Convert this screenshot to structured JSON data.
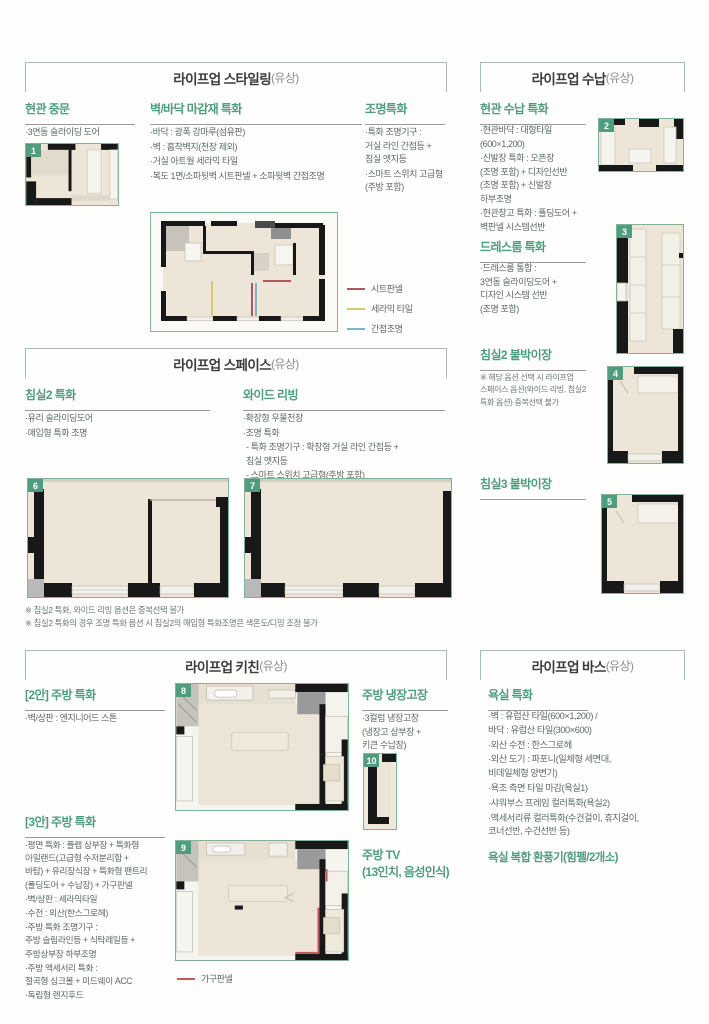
{
  "colors": {
    "accent_green": "#4f9d7e",
    "box_border": "#a3bfb1",
    "body_text": "#5c6b63",
    "wall_black": "#181818",
    "floor_beige": "#ece5d8"
  },
  "styling": {
    "title": "라이프업 스타일링",
    "paid": "(유상)",
    "badge": "1",
    "door": {
      "heading": "현관 중문",
      "items": [
        "·3연동 슬라이딩 도어"
      ]
    },
    "finish": {
      "heading": "벽/바닥 마감재 특화",
      "items": [
        "·바닥 : 광폭 강마루(섬유판)",
        "·벽 : 흡착벽지(천장 제외)",
        "·거실 아트월 세라믹 타일",
        "·복도 1면/소파뒷벽 시트판넬 + 소파뒷벽 간접조명"
      ]
    },
    "lighting": {
      "heading": "조명특화",
      "items": [
        "·특화 조명기구 :\n거실 라인 간접등 +\n침실 엣지등",
        "·스마트 스위치 고급형\n(주방 포함)"
      ]
    },
    "legend": [
      {
        "label": "시트판넬",
        "color": "#b2575b"
      },
      {
        "label": "세라믹 타일",
        "color": "#d9c96d"
      },
      {
        "label": "간접조명",
        "color": "#7db5c9"
      }
    ]
  },
  "sunap": {
    "title": "라이프업 수납",
    "paid": "(유상)",
    "badge2": "2",
    "badge3": "3",
    "badge4": "4",
    "badge5": "5",
    "entry": {
      "heading": "현관 수납 특화",
      "items": [
        "·현관바닥 : 대형타일\n(600×1,200)",
        "·신발장 특화 : 오픈장\n(조명 포함) + 디자인선반\n(조명 포함) + 신발장\n하부조명",
        "·현관창고 특화 : 폴딩도어 +\n벽판넬 시스템선반"
      ]
    },
    "dress": {
      "heading": "드레스룸 특화",
      "items": [
        "·드레스룸 통합 :\n3연동 슬라이딩도어 +\n디자인 시스템 선반\n(조명 포함)"
      ]
    },
    "bed2": {
      "heading": "침실2 붙박이장",
      "note": "※ 해당 옵션 선택 시 라이프업\n스페이스 옵션(와이드 리빙, 침실2\n특화 옵션) 중복선택 불가"
    },
    "bed3": {
      "heading": "침실3 붙박이장"
    }
  },
  "space": {
    "title": "라이프업 스페이스",
    "paid": "(유상)",
    "badge6": "6",
    "badge7": "7",
    "bed2": {
      "heading": "침실2 특화",
      "items": [
        "·유리 슬라이딩도어",
        "·매입형 특화 조명"
      ]
    },
    "wide": {
      "heading": "와이드 리빙",
      "items": [
        "·확장형 우물천장",
        "·조명 특화",
        "- 특화 조명기구 : 확장형 거실 라인 간접등 +\n침실 엣지등",
        "- 스마트 스위치 고급형(주방 포함)"
      ]
    },
    "notes": [
      "※ 침실2 특화, 와이드 리빙 옵션은 중복선택 불가",
      "※ 침실2 특화의 경우 조명 특화 옵션 시 침실2의 매입형 특화조명은 색온도/디밍 조정 불가"
    ]
  },
  "kitchen": {
    "title": "라이프업 키친",
    "paid": "(유상)",
    "badge8": "8",
    "badge9": "9",
    "badge10": "10",
    "plan2": {
      "heading": "[2안] 주방 특화",
      "items": [
        "·벽/상판 : 엔지니어드 스톤"
      ]
    },
    "plan3": {
      "heading": "[3안] 주방 특화",
      "items": [
        "·평면 특화 : 플랩 상부장 + 특화형\n아일랜드(고급형 수저분리함 +\n바탑) + 유리장식장 + 특화형 팬트리\n(폴딩도어 + 수납장) + 가구판넬",
        "·벽/상판 : 세라믹타일",
        "·수전 : 외산(한스그로헤)",
        "·주방 특화 조명기구 :\n주방 슬림라인등 + 식탁레일등 +\n주방상부장 하부조명",
        "·주방 액세서리 특화 :\n절곡형 싱크볼 + 미드웨이 ACC",
        "·독립형 렌지후드"
      ]
    },
    "fridge": {
      "heading": "주방 냉장고장",
      "items": [
        "·3컬럼 냉장고장\n(냉장고 상부장 +\n키큰 수납장)"
      ]
    },
    "tv": {
      "heading": "주방 TV\n(13인치, 음성인식)"
    },
    "legend": [
      {
        "label": "가구판넬",
        "color": "#c05a5d"
      }
    ]
  },
  "bath": {
    "title": "라이프업 바스",
    "paid": "(유상)",
    "feature": {
      "heading": "욕실 특화",
      "items": [
        "·벽 : 유럽산 타일(600×1,200) /\n바닥 : 유럽산 타일(300×600)",
        "·외산 수전 : 한스그로헤",
        "·외산 도기 : 파포니(일체형 세면대,\n비데일체형 양변기)",
        "·욕조 측면 타일 마감(욕실1)",
        "·샤워부스 프레임 컬러특화(욕실2)",
        "·액세서리류 컬러특화(수건걸이, 휴지걸이,\n코너선반, 수건선반 등)"
      ]
    },
    "fan": {
      "heading": "욕실 복합 환풍기(힘펠/2개소)"
    }
  }
}
